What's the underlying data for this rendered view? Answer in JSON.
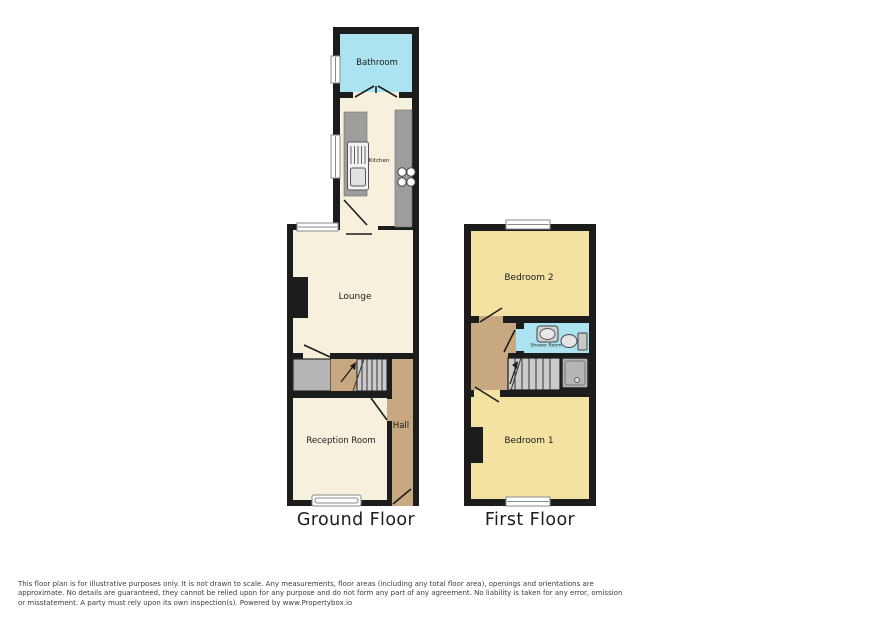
{
  "floorplan": {
    "ground_floor": {
      "title": "Ground Floor",
      "rooms": {
        "bathroom": "Bathroom",
        "kitchen": "Kitchen",
        "lounge": "Lounge",
        "reception_room": "Reception Room",
        "hall": "Hall"
      }
    },
    "first_floor": {
      "title": "First Floor",
      "rooms": {
        "bedroom2": "Bedroom 2",
        "shower_room": "Shower Room",
        "bedroom1": "Bedroom 1"
      }
    },
    "colors": {
      "wall": "#1c1c1c",
      "ground_room_fill": "#f6f0dc",
      "bedroom_fill": "#f3e2a2",
      "wet_room_fill": "#abe4f0",
      "hall_fill": "#c8a880",
      "counter_gray": "#9d9d9d",
      "stairs_gray": "#cbcbcb",
      "cupboard_gray": "#b6b6b6",
      "window_fill": "#ffffff"
    }
  },
  "footer": {
    "disclaimer": "This floor plan is for illustrative purposes only. It is not drawn to scale. Any measurements, floor areas (including any total floor area), openings and orientations are approximate. No details are guaranteed, they cannot be relied upon for any purpose and do not form any part of any agreement. No liability is taken for any error, omission or misstatement. A party must rely upon its own inspection(s). Powered by www.Propertybox.io"
  }
}
